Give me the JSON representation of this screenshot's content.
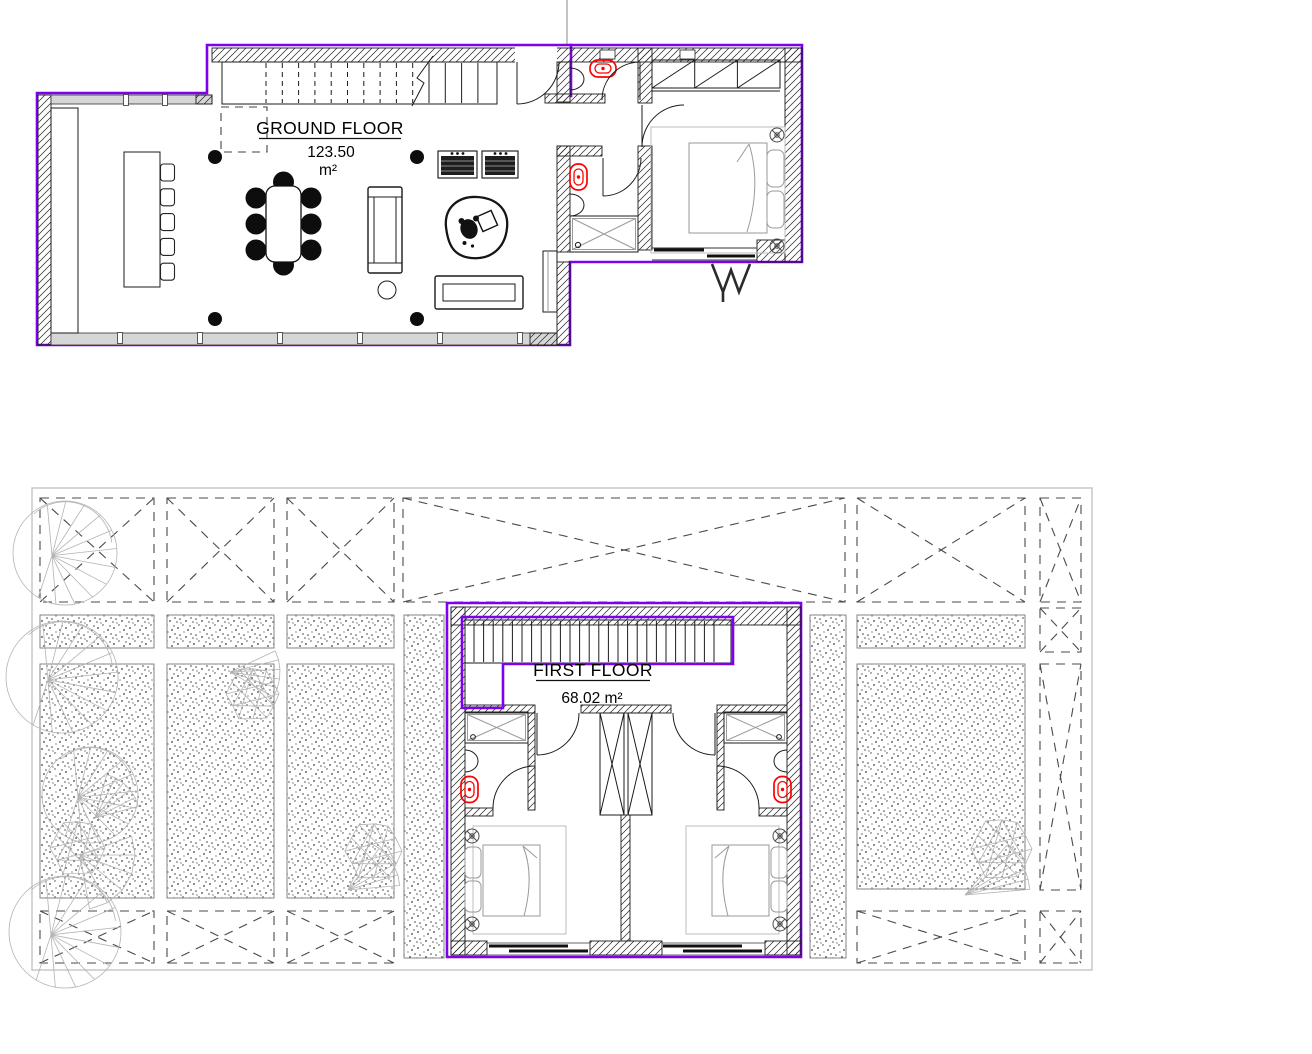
{
  "colors": {
    "outline": "#7E00F0",
    "fixtures": "#FF0000"
  },
  "ground_floor": {
    "title": "GROUND FLOOR",
    "area": "123.50",
    "unit": "m²"
  },
  "first_floor": {
    "title": "FIRST FLOOR",
    "area": "68.02 m²"
  }
}
